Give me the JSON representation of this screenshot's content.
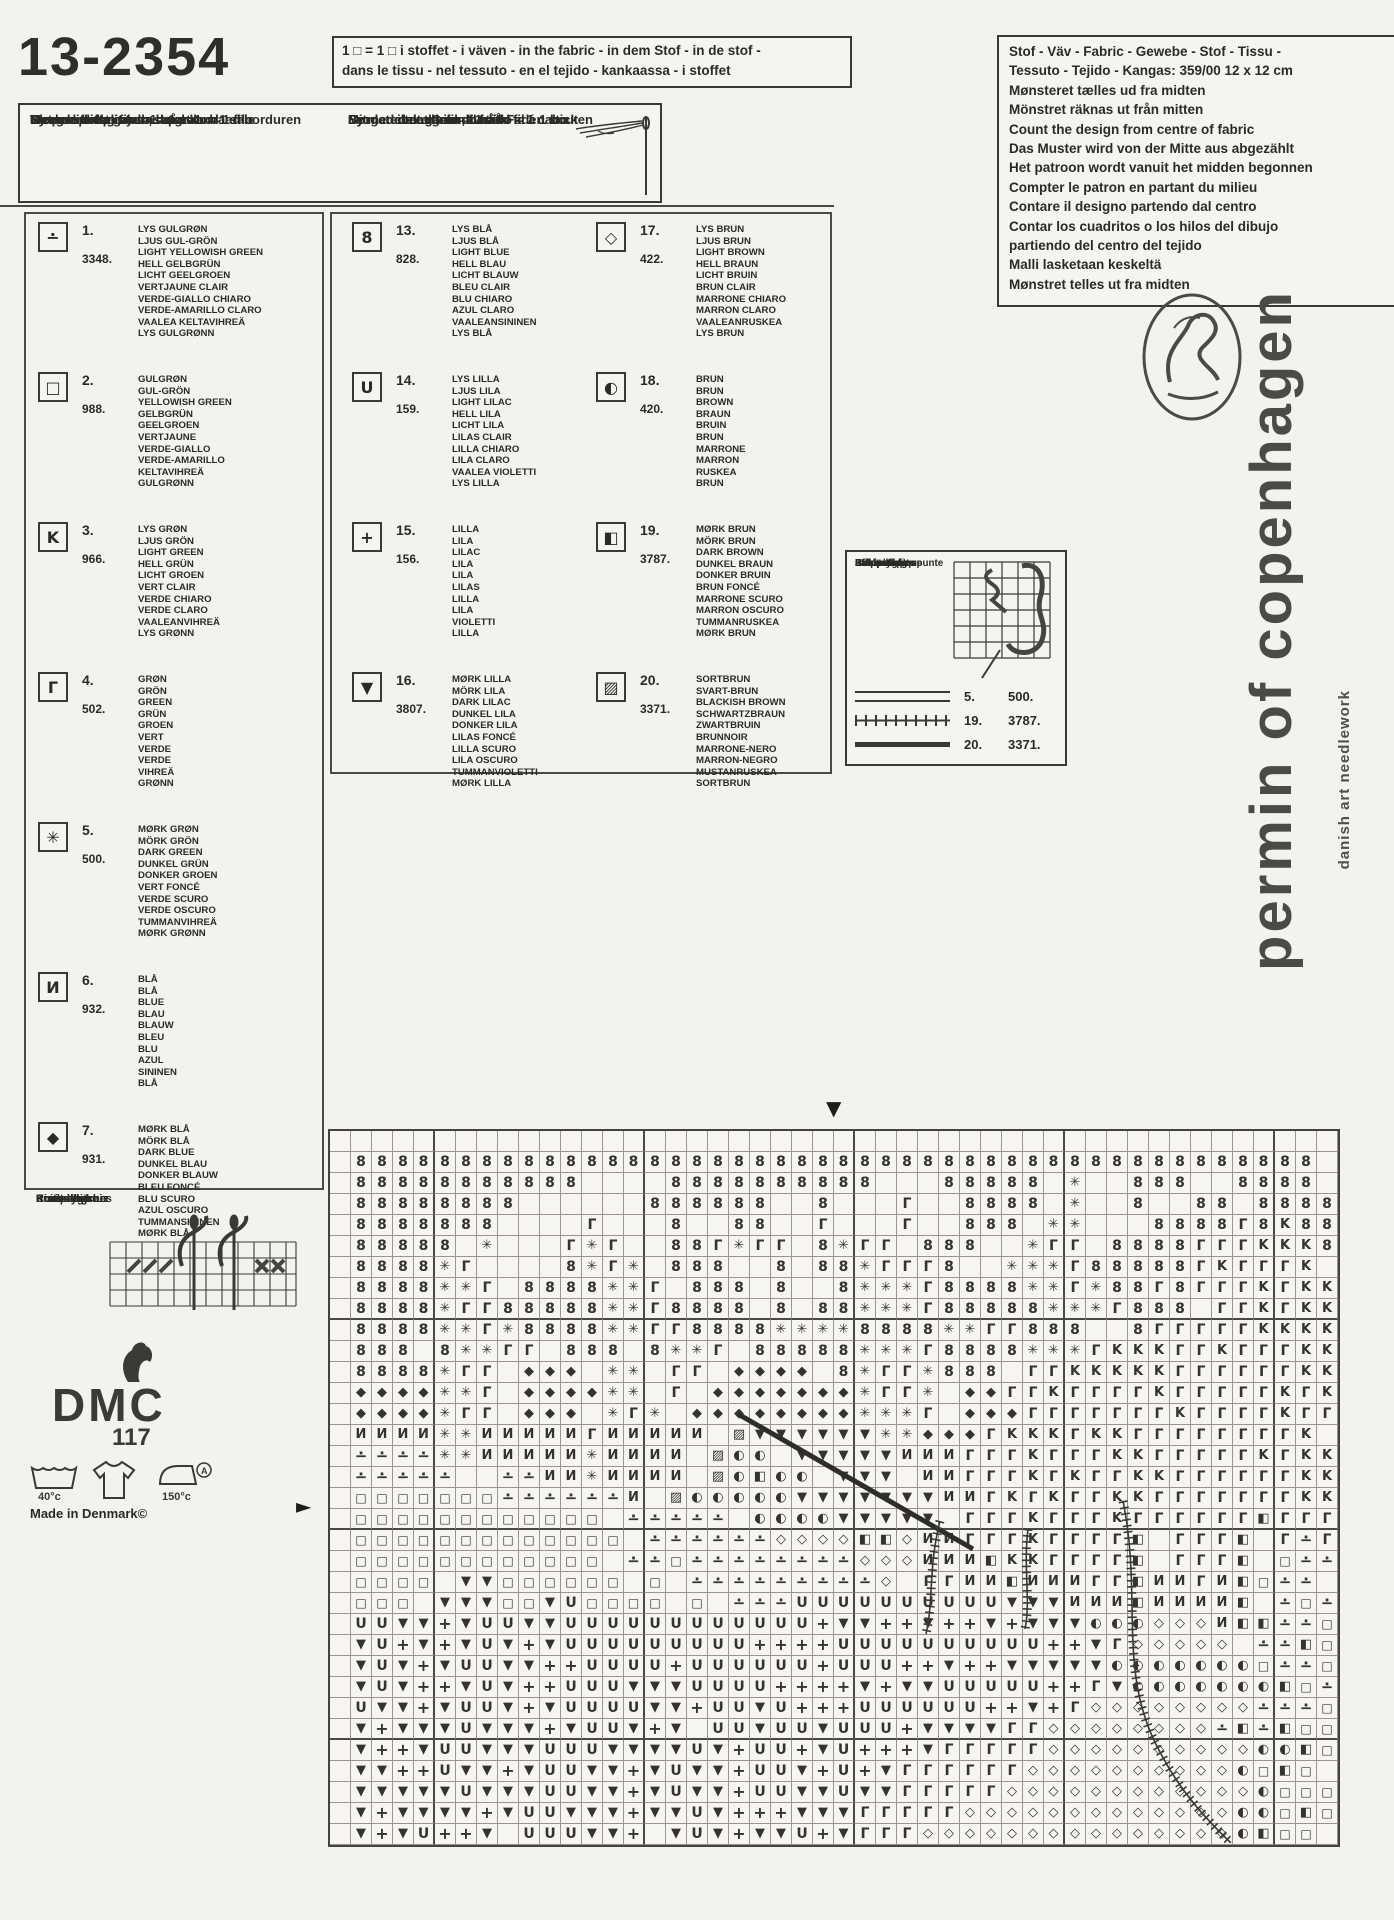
{
  "page": {
    "paper": "#f3f2ed",
    "ink": "#2b2a27",
    "grid_line": "#98968f"
  },
  "title": "13-2354",
  "fabric_note": {
    "line1": "1 □ = 1 □ i stoffet - i väven - in the fabric - in dem Stof - in de stof -",
    "line2": "dans le tissu - nel tessuto - en el tejido - kankaassa - i stoffet"
  },
  "split_yarn": {
    "left": [
      "Sy med delt garn = 1 tråd",
      "Work with split yarn = 1 strand",
      "Met gesplitst garen, d.w.z. 1 draad borduren",
      "Ricamare con filato separato = 1 filo",
      "Ompele halkaistulla langalla = 1 säie"
    ],
    "right": [
      "Sy med delat garn = 1 tråd",
      "Mit geteiltem Garn, d.h. 1 Faden sticken",
      "Broder avec du fil divisé = fil á 1 bout",
      "Bordar con el hilo dividido = 1 cabo",
      "Sy med delt garn = 1 tråd"
    ]
  },
  "fabric_info": {
    "lines": [
      "Stof - Väv - Fabric - Gewebe - Stof - Tissu -",
      "Tessuto - Tejido - Kangas: 359/00  12 x 12 cm",
      "Mønsteret tælles ud fra midten",
      "Mönstret räknas ut från mitten",
      "Count the design from centre of fabric",
      "Das Muster wird von der Mitte aus abgezählt",
      "Het patroon wordt vanuit het midden begonnen",
      "Compter le patron en partant du milieu",
      "Contare il designo partendo dal centro",
      "Contar los cuadritos o los hilos del dibujo",
      "partiendo del centro del tejido",
      "Malli lasketaan keskeltä",
      "Mønstret telles ut fra midten"
    ]
  },
  "legend": {
    "entries": [
      {
        "col": "c1",
        "num": "1.",
        "code": "3348.",
        "sym": "∸",
        "names": [
          "LYS GULGRØN",
          "LJUS GUL-GRÖN",
          "LIGHT YELLOWISH GREEN",
          "HELL GELBGRÜN",
          "LICHT GEELGROEN",
          "VERTJAUNE CLAIR",
          "VERDE-GIALLO CHIARO",
          "VERDE-AMARILLO CLARO",
          "VAALEA KELTAVIHREÄ",
          "LYS GULGRØNN"
        ]
      },
      {
        "col": "c1",
        "num": "2.",
        "code": "988.",
        "sym": "□",
        "names": [
          "GULGRØN",
          "GUL-GRÖN",
          "YELLOWISH GREEN",
          "GELBGRÜN",
          "GEELGROEN",
          "VERTJAUNE",
          "VERDE-GIALLO",
          "VERDE-AMARILLO",
          "KELTAVIHREÄ",
          "GULGRØNN"
        ]
      },
      {
        "col": "c1",
        "num": "3.",
        "code": "966.",
        "sym": "K",
        "names": [
          "LYS GRØN",
          "LJUS GRÖN",
          "LIGHT GREEN",
          "HELL GRÜN",
          "LICHT GROEN",
          "VERT CLAIR",
          "VERDE CHIARO",
          "VERDE CLARO",
          "VAALEANVIHREÄ",
          "LYS GRØNN"
        ]
      },
      {
        "col": "c1",
        "num": "4.",
        "code": "502.",
        "sym": "Γ",
        "names": [
          "GRØN",
          "GRÖN",
          "GREEN",
          "GRÜN",
          "GROEN",
          "VERT",
          "VERDE",
          "VERDE",
          "VIHREÄ",
          "GRØNN"
        ]
      },
      {
        "col": "c1",
        "num": "5.",
        "code": "500.",
        "sym": "✳",
        "names": [
          "MØRK GRØN",
          "MÖRK GRÖN",
          "DARK GREEN",
          "DUNKEL GRÜN",
          "DONKER GROEN",
          "VERT FONCÉ",
          "VERDE SCURO",
          "VERDE OSCURO",
          "TUMMANVIHREÄ",
          "MØRK GRØNN"
        ]
      },
      {
        "col": "c1",
        "num": "6.",
        "code": "932.",
        "sym": "И",
        "names": [
          "BLÅ",
          "BLÅ",
          "BLUE",
          "BLAU",
          "BLAUW",
          "BLEU",
          "BLU",
          "AZUL",
          "SININEN",
          "BLÅ"
        ]
      },
      {
        "col": "c1",
        "num": "7.",
        "code": "931.",
        "sym": "◆",
        "names": [
          "MØRK BLÅ",
          "MÖRK BLÅ",
          "DARK BLUE",
          "DUNKEL BLAU",
          "DONKER BLAUW",
          "BLEU FONCÉ",
          "BLU SCURO",
          "AZUL OSCURO",
          "TUMMANSININEN",
          "MØRK BLÅ"
        ]
      },
      {
        "col": "c2",
        "num": "13.",
        "code": "828.",
        "sym": "8",
        "names": [
          "LYS BLÅ",
          "LJUS BLÅ",
          "LIGHT BLUE",
          "HELL BLAU",
          "LICHT BLAUW",
          "BLEU CLAIR",
          "BLU CHIARO",
          "AZUL CLARO",
          "VAALEANSININEN",
          "LYS BLÅ"
        ]
      },
      {
        "col": "c2",
        "num": "14.",
        "code": "159.",
        "sym": "U",
        "names": [
          "LYS LILLA",
          "LJUS LILA",
          "LIGHT LILAC",
          "HELL LILA",
          "LICHT LILA",
          "LILAS CLAIR",
          "LILLA CHIARO",
          "LILA CLARO",
          "VAALEA VIOLETTI",
          "LYS LILLA"
        ]
      },
      {
        "col": "c2",
        "num": "15.",
        "code": "156.",
        "sym": "+",
        "names": [
          "LILLA",
          "LILA",
          "LILAC",
          "LILA",
          "LILA",
          "LILAS",
          "LILLA",
          "LILA",
          "VIOLETTI",
          "LILLA"
        ]
      },
      {
        "col": "c2",
        "num": "16.",
        "code": "3807.",
        "sym": "▼",
        "names": [
          "MØRK LILLA",
          "MÖRK LILA",
          "DARK LILAC",
          "DUNKEL LILA",
          "DONKER LILA",
          "LILAS FONCÉ",
          "LILLA SCURO",
          "LILA OSCURO",
          "TUMMANVIOLETTI",
          "MØRK LILLA"
        ]
      },
      {
        "col": "c3",
        "num": "17.",
        "code": "422.",
        "sym": "◇",
        "names": [
          "LYS BRUN",
          "LJUS BRUN",
          "LIGHT BROWN",
          "HELL BRAUN",
          "LICHT BRUIN",
          "BRUN CLAIR",
          "MARRONE CHIARO",
          "MARRON CLARO",
          "VAALEANRUSKEA",
          "LYS BRUN"
        ]
      },
      {
        "col": "c3",
        "num": "18.",
        "code": "420.",
        "sym": "◐",
        "names": [
          "BRUN",
          "BRUN",
          "BROWN",
          "BRAUN",
          "BRUIN",
          "BRUN",
          "MARRONE",
          "MARRON",
          "RUSKEA",
          "BRUN"
        ]
      },
      {
        "col": "c3",
        "num": "19.",
        "code": "3787.",
        "sym": "◧",
        "names": [
          "MØRK BRUN",
          "MÖRK BRUN",
          "DARK BROWN",
          "DUNKEL BRAUN",
          "DONKER BRUIN",
          "BRUN FONCÉ",
          "MARRONE SCURO",
          "MARRON OSCURO",
          "TUMMANRUSKEA",
          "MØRK BRUN"
        ]
      },
      {
        "col": "c3",
        "num": "20.",
        "code": "3371.",
        "sym": "▨",
        "names": [
          "SORTBRUN",
          "SVART-BRUN",
          "BLACKISH BROWN",
          "SCHWARTZBRAUN",
          "ZWARTBRUIN",
          "BRUNNOIR",
          "MARRONE-NERO",
          "MARRON-NEGRO",
          "MUSTANRUSKEA",
          "SORTBRUN"
        ]
      }
    ]
  },
  "backstitch": {
    "labels": [
      "Stikkesting",
      "Efterstygn",
      "Back stiches",
      "Steppstiche",
      "Point de pique",
      "Stiksteek",
      "Punto scritto",
      "Punto de pespunte",
      "Jälkipisto",
      "Stikkesting"
    ],
    "rows": [
      {
        "style": "double",
        "num": "5.",
        "code": "500."
      },
      {
        "style": "ticks",
        "num": "19.",
        "code": "3787."
      },
      {
        "style": "solid",
        "num": "20.",
        "code": "3371."
      }
    ]
  },
  "cross_stitch": {
    "labels": [
      "Korssting",
      "Korsstygn",
      "Cross stitches",
      "Kreuzstiche",
      "Point de croix",
      "Kruissteek",
      "Punto croce",
      "Punto de cruz",
      "Ristipisto",
      "Korssting"
    ]
  },
  "dmc": {
    "word": "DMC",
    "number": "117"
  },
  "laundry": {
    "wash": "40°c",
    "iron": "150°c",
    "letter": "A"
  },
  "made_in": "Made in Denmark©",
  "brand": {
    "name": "permin of copenhagen",
    "tagline": "danish art needlework"
  },
  "markers": {
    "top": "▼",
    "left": "►"
  },
  "chart_grid": {
    "cols": 48,
    "rows": 34,
    "cell_px": 21,
    "bold_after_cols": [
      5,
      15,
      25,
      35,
      45
    ],
    "bold_after_rows": [
      9,
      19,
      29
    ],
    "symbols": {
      "8": {
        "glyph": "8",
        "thread": "828",
        "size": 14
      },
      "U": {
        "glyph": "U",
        "thread": "159",
        "size": 14
      },
      "+": {
        "glyph": "+",
        "thread": "156",
        "size": 16
      },
      "V": {
        "glyph": "▼",
        "thread": "3807",
        "size": 13
      },
      "K": {
        "glyph": "K",
        "thread": "966",
        "size": 13
      },
      "r": {
        "glyph": "Γ",
        "thread": "502",
        "size": 14
      },
      "*": {
        "glyph": "✳",
        "thread": "500",
        "size": 13
      },
      "N": {
        "glyph": "И",
        "thread": "932",
        "size": 13
      },
      "D": {
        "glyph": "◆",
        "thread": "931",
        "size": 13
      },
      ".": {
        "glyph": "∸",
        "thread": "3348",
        "size": 15
      },
      "q": {
        "glyph": "□",
        "thread": "988",
        "size": 12
      },
      "d": {
        "glyph": "◇",
        "thread": "422",
        "size": 13
      },
      "o": {
        "glyph": "◐",
        "thread": "420",
        "size": 13
      },
      "B": {
        "glyph": "◧",
        "thread": "3787",
        "size": 13
      },
      "Z": {
        "glyph": "▨",
        "thread": "3371",
        "size": 13
      }
    },
    "cells": [
      "                                                ",
      " 8888888888888888888888888888888888888888888888",
      " 88888888888    8888888888   88888 *  888  8888 ",
      " 88888888      888888  8   r  8888 *  8  88 8888",
      " 8888888    r   8  88  r   r  888 **   8888r8K88",
      " 88888 *   r*r  88r*rr 8*rr 888  *rr 8888rrrKKK8",
      " 8888*r    8*r* 888  8 88*rrr8  ***r88888rKrrrK ",
      " 8888**r 8888**r 888 8  8***r8888**r*88r8rrrKrKK",
      " 8888*rr88888**r8888 8 88***r88888***r888 rrKrKK",
      " 8888**r*8888**rr8888****8888**rr888  8rrrrrKKKK",
      " 888 8**rr 888 8**r 88888***r8888***rKKKrrKrrrKK",
      " 8888*rr DDD ** rr DDDD 8*rr*888 rrKKKKKrrrrrrKK",
      " DDDD**r DDDD** r DDDDDDD*rr* DDrrKrrrrKrrrrrKrK",
      " DDDD*rr DDD *r* DDDDDDDD***r DDDrrrrrrrKrrrrKrr",
      " NNNN**NNNNNrNNNNN ZVVVVVV**DDDrKKKrKKrrrrrrrrK ",
      " ....**NNNNN*NNNN Zoo VVVVVNNNrrrKrrrKKrrrrrKrKK",
      " .....  ..NN*NNNN ZoBoo VVV NNrrrKrKrrKKrrrrrrKK",
      " qqqqqqq......N ZoooooVVVVVVVNNrKrKrrKKrrrrrrrKK",
      " qqqqqqqqqqqq ..... ooooVVVVV rrrKrrrKrrrrrrBrrr",
      " qqqqqqqqqqqqq ......ddddBBdNNrrrKrrrrB rrrB r.r",
      " qqqqqqqqqqqq ..q........dddNNNBKKrrrrB rrrB q..",
      " qqqq VVqqqqqq q .........d rrNNBNNNrrBNNrNBq..",
      " qqq VVVqqVUqqqq q ...UUUUUUUUUUVVVNNNBNNNNB .q.",
      " UUVV+VUUVVUUUUUUUUUUUU+VV++V++V+VVVooodddNBB..q",
      " VU+V+VUV+VUUUUUUUUU++++UUUUUUUUUU++Vrddddd ..Bq",
      " VUV+VUUVV++UUUU+UUUUUU+UUU++V++VVVVVoooooooq..q",
      " VUV++VUV++UUUVVVUUUU++++V+VVUUUUU++rVoooooooBq.",
      " UVV+VUUV+VUUUUVV+UUVU+++UUUUUU++V+rdddddddd...q",
      " V+VVVUVVV+VUUV+V UUVUUVUUU+VVVVrrdddddddd.B.Bqq",
      " V++VUUVVVUUUVVVVUV+UU+VU+++VrrrrrddddddddddooBq",
      " VV++UVV+VUUVV+VUVV+UUV+U+VrrrrrrddddddddddoqBq",
      " VVVVVUVVVUUVV+VUVV+UUVVUVVrrrrrddddddddddddoqqq",
      " V+VVVV+VUUVVV+VVUV+++VVVrrrrrdddddddddddddooqBq",
      " V+VU++V UUUVV+ VUV+VVU+VrrrdddddddddddddddoBqq "
    ],
    "backstitch_lines": [
      {
        "thread": "3371",
        "style": "solid",
        "from": [
          410,
          285
        ],
        "to": [
          645,
          420
        ]
      },
      {
        "thread": "3787",
        "style": "ticks",
        "path": "M 612 392 C 600 440, 606 470, 598 505"
      },
      {
        "thread": "3787",
        "style": "ticks",
        "path": "M 700 400 C 695 440, 703 470, 697 500"
      },
      {
        "thread": "3787",
        "style": "ticks",
        "path": "M 795 372 C 815 470, 788 545, 833 625 C 853 663, 878 690, 903 714"
      }
    ]
  }
}
